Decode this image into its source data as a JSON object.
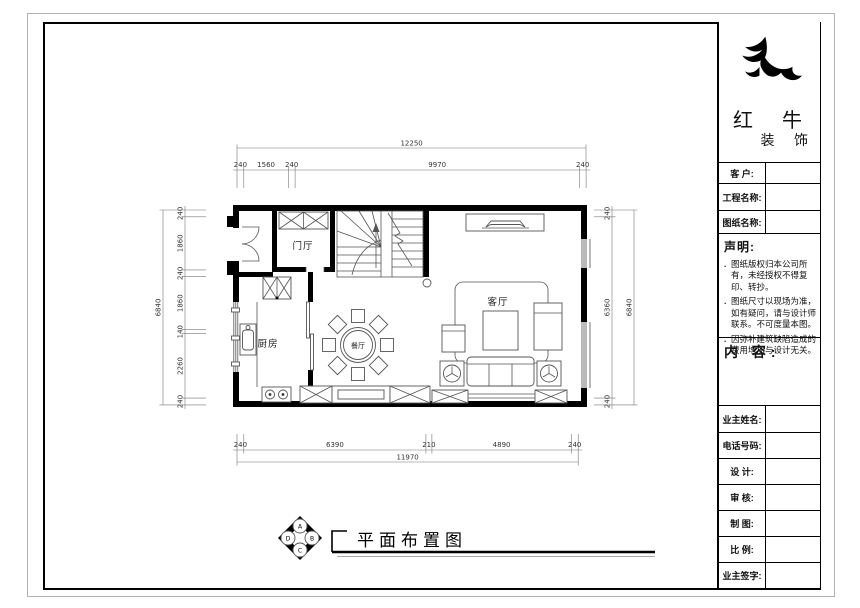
{
  "brand": {
    "name_line1": "红 牛",
    "name_line2": "装 饰"
  },
  "titleblock": {
    "customer_label": "客  户:",
    "project_label": "工程名称:",
    "drawing_label": "图纸名称:",
    "statement": {
      "title": "声明:",
      "bullet": ".",
      "items": [
        "图纸版权归本公司所有，未经授权不得复印、转抄。",
        "图纸尺寸以现场为准，如有疑问，请与设计师联系。不可度量本图。",
        "因弥补建筑缺陷造成的费用增加与设计无关。"
      ]
    },
    "content_label": "内 容:",
    "owner_label": "业主姓名:",
    "phone_label": "电话号码:",
    "design_label": "设 计:",
    "review_label": "审 核:",
    "draft_label": "制 图:",
    "scale_label": "比 例:",
    "sign_label": "业主签字:"
  },
  "plan": {
    "rooms": {
      "foyer": "门厅",
      "kitchen": "厨房",
      "dining": "餐厅",
      "living": "客厅"
    },
    "title": "平面布置图",
    "elevation_symbol": {
      "top": "A",
      "right": "B",
      "bottom": "C",
      "left": "D"
    },
    "dims": {
      "top_total": "12250",
      "top": [
        "240",
        "1560",
        "240",
        "9970",
        "240"
      ],
      "bottom": [
        "240",
        "6390",
        "210",
        "4890",
        "240"
      ],
      "bottom_total": "11970",
      "left_total": "6840",
      "left": [
        "240",
        "1860",
        "240",
        "1860",
        "140",
        "2260",
        "240"
      ],
      "right": [
        "240",
        "6360",
        "240"
      ],
      "right_total": "6840"
    }
  }
}
